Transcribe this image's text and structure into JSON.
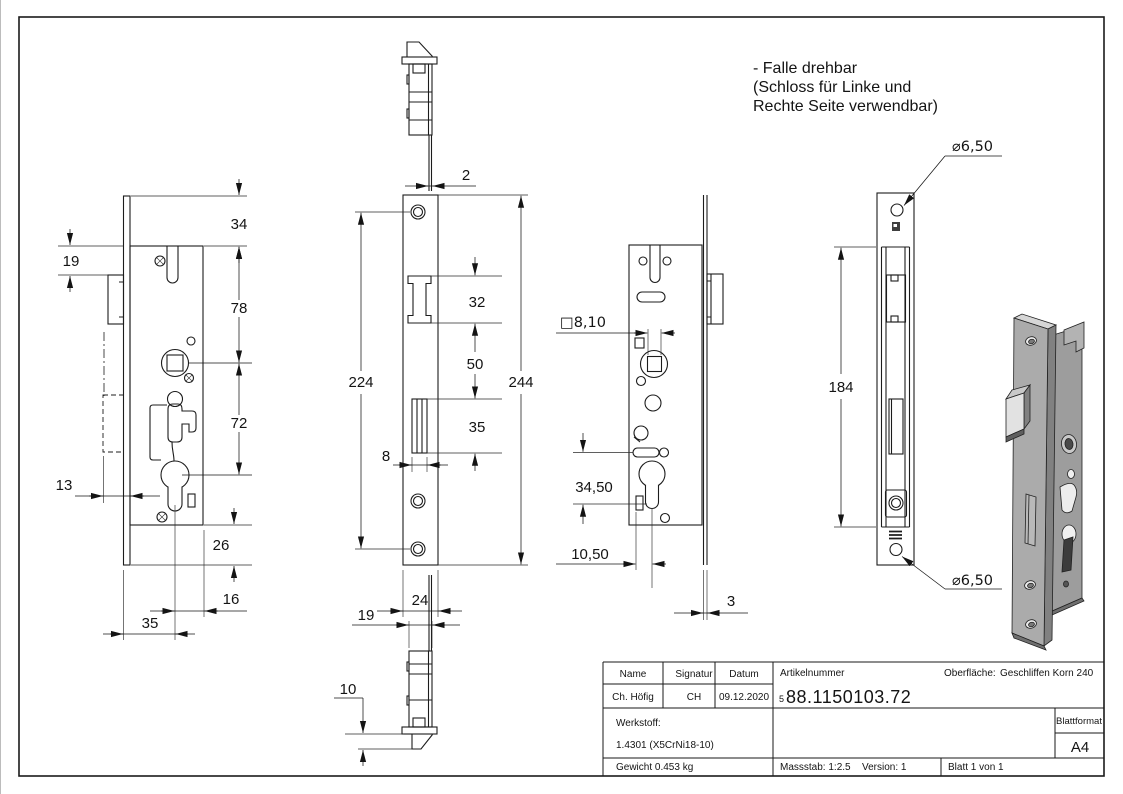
{
  "annotation_note": {
    "lines": [
      "- Falle drehbar",
      "(Schloss für Linke und",
      "Rechte Seite verwendbar)"
    ]
  },
  "views": {
    "side_view": {
      "dims": {
        "d34": "34",
        "d19": "19",
        "d78": "78",
        "d72": "72",
        "d13": "13",
        "d26": "26",
        "d16": "16",
        "d35": "35"
      }
    },
    "front_view": {
      "dims": {
        "d2": "2",
        "d224": "224",
        "d244": "244",
        "d32": "32",
        "d50": "50",
        "d35": "35",
        "d8": "8",
        "d24": "24",
        "d19": "19",
        "d10": "10"
      }
    },
    "back_view": {
      "dims": {
        "d8_10": "□8,10",
        "d34_50": "34,50",
        "d10_50": "10,50",
        "d3": "3"
      }
    },
    "faceplate_view": {
      "dims": {
        "d184": "184",
        "dia_top": "⌀6,50",
        "dia_bottom": "⌀6,50"
      }
    }
  },
  "title_block": {
    "name_label": "Name",
    "signatur_label": "Signatur",
    "datum_label": "Datum",
    "name_value": "Ch. Höfig",
    "signatur_value": "CH",
    "datum_value": "09.12.2020",
    "artikelnummer_label": "Artikelnummer",
    "artikelnummer_prefix": "5",
    "artikelnummer_value": "88.1150103.72",
    "oberflaeche_label": "Oberfläche:",
    "oberflaeche_value": "Geschliffen Korn 240",
    "werkstoff_label": "Werkstoff:",
    "werkstoff_value": "1.4301 (X5CrNi18-10)",
    "blattformat_label": "Blattformat",
    "blattformat_value": "A4",
    "gewicht_value": "Gewicht 0.453 kg",
    "massstab_value": "Massstab: 1:2.5",
    "version_value": "Version: 1",
    "blatt_value": "Blatt 1 von 1"
  }
}
